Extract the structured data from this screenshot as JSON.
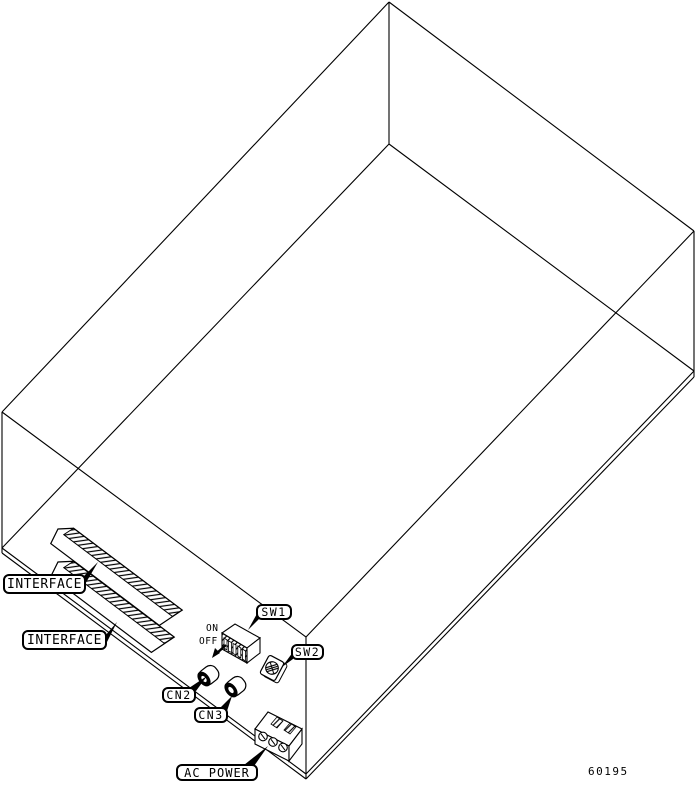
{
  "figure": {
    "figure_number": "60195",
    "labels": {
      "interface_top": "INTERFACE",
      "interface_bottom": "INTERFACE",
      "sw1": "SW1",
      "sw2": "SW2",
      "cn2": "CN2",
      "cn3": "CN3",
      "ac_power": "AC POWER",
      "dip_on": "ON",
      "dip_off": "OFF"
    },
    "colors": {
      "line": "#000000",
      "background": "#ffffff"
    }
  }
}
